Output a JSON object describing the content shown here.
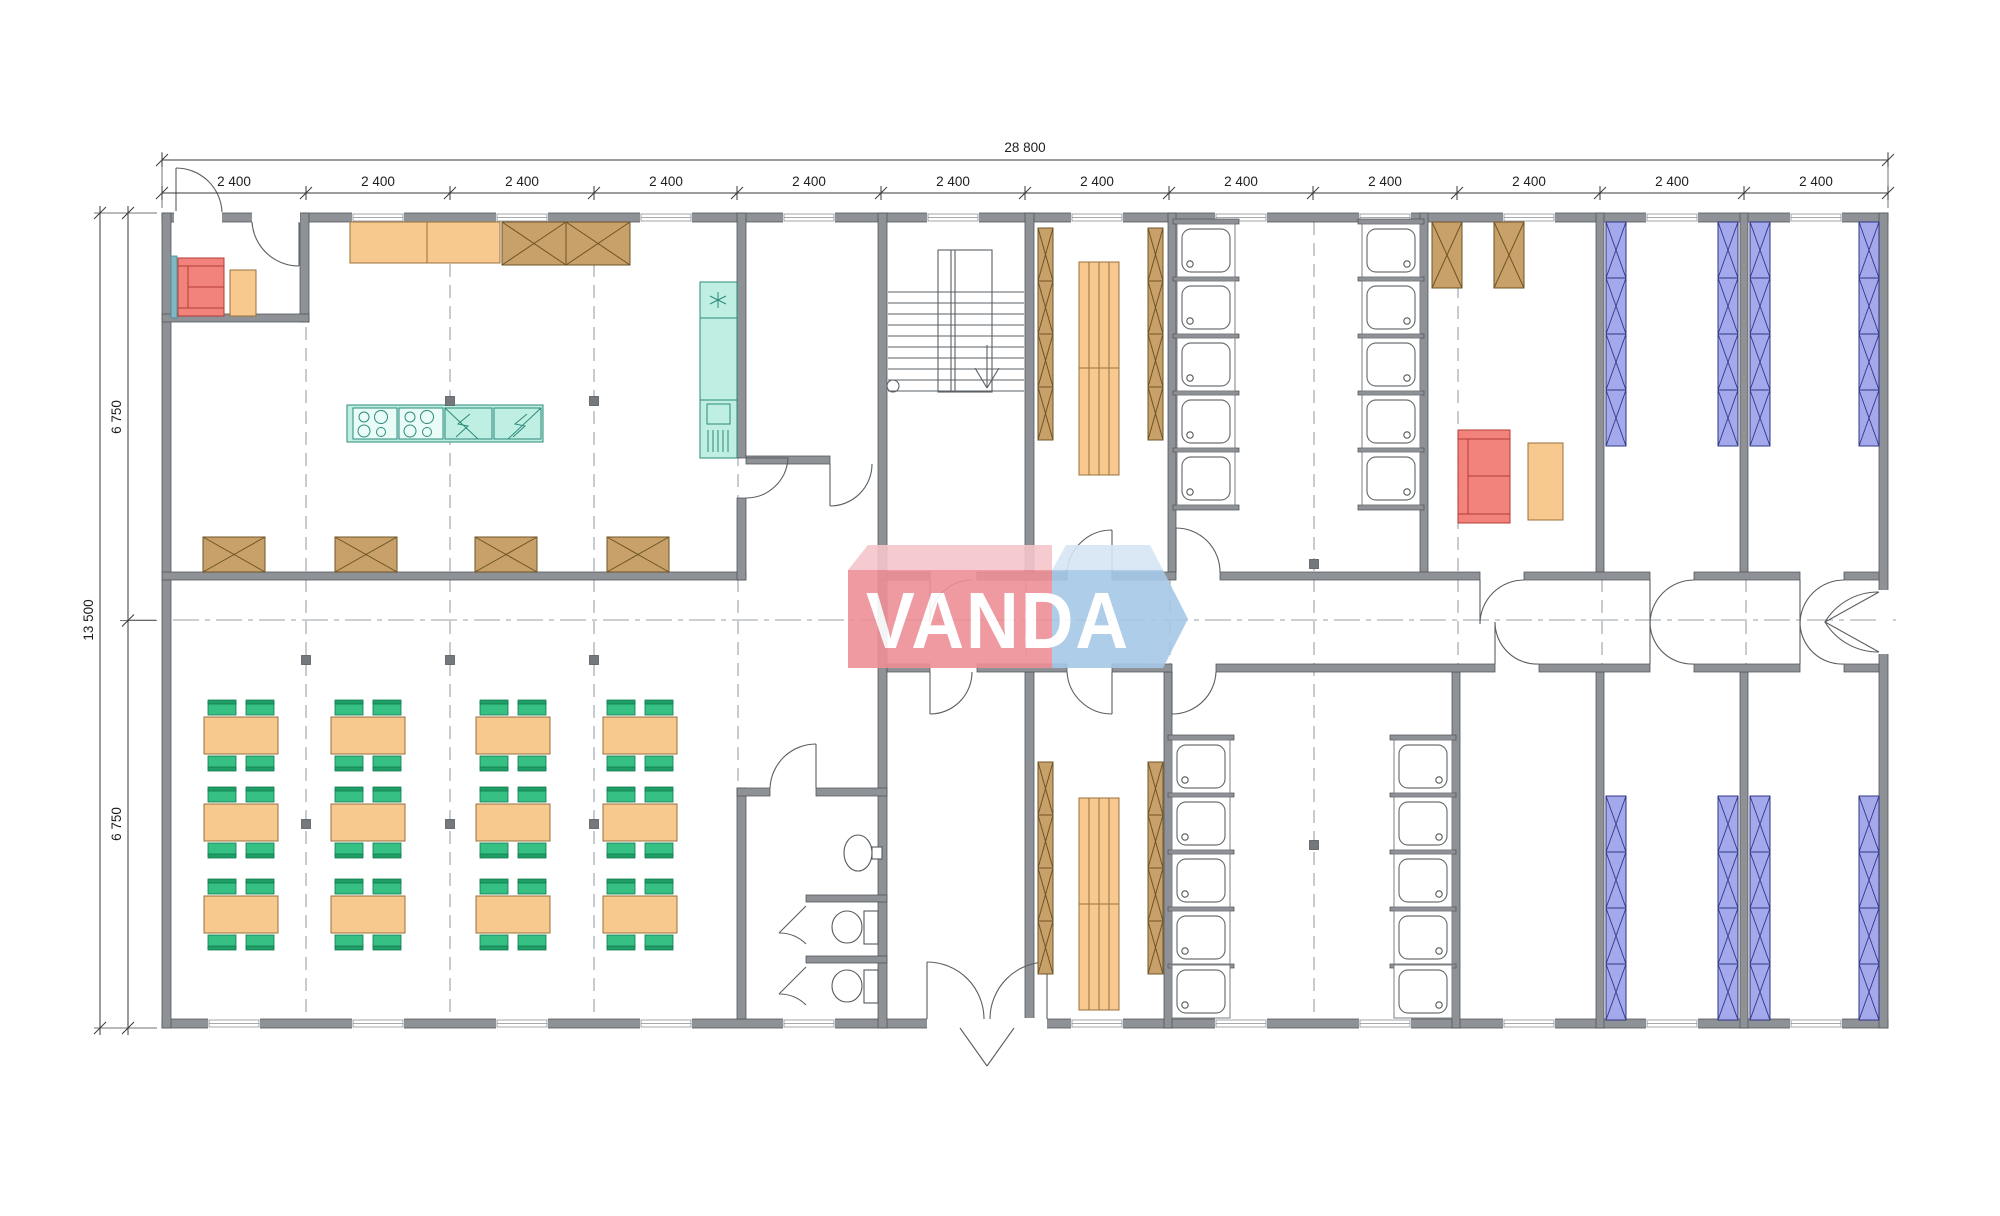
{
  "watermark": {
    "text": "VANDA"
  },
  "dimensions": {
    "top_total": "28 800",
    "top_segments": [
      "2 400",
      "2 400",
      "2 400",
      "2 400",
      "2 400",
      "2 400",
      "2 400",
      "2 400",
      "2 400",
      "2 400",
      "2 400",
      "2 400"
    ],
    "left_total": "13 500",
    "left_segments": [
      "6 750",
      "6 750"
    ]
  },
  "colors": {
    "wall": "#8e9296",
    "wood_furniture": "#f8c98e",
    "wardrobe_crossed": "#c7a169",
    "chair_green": "#36c083",
    "sofa_red": "#f2837c",
    "kitchen_teal": "#bfeee2",
    "bunk_purple": "#a3a9ea",
    "logo_red": "#ee8e97",
    "logo_blue": "#a6c8e7"
  }
}
